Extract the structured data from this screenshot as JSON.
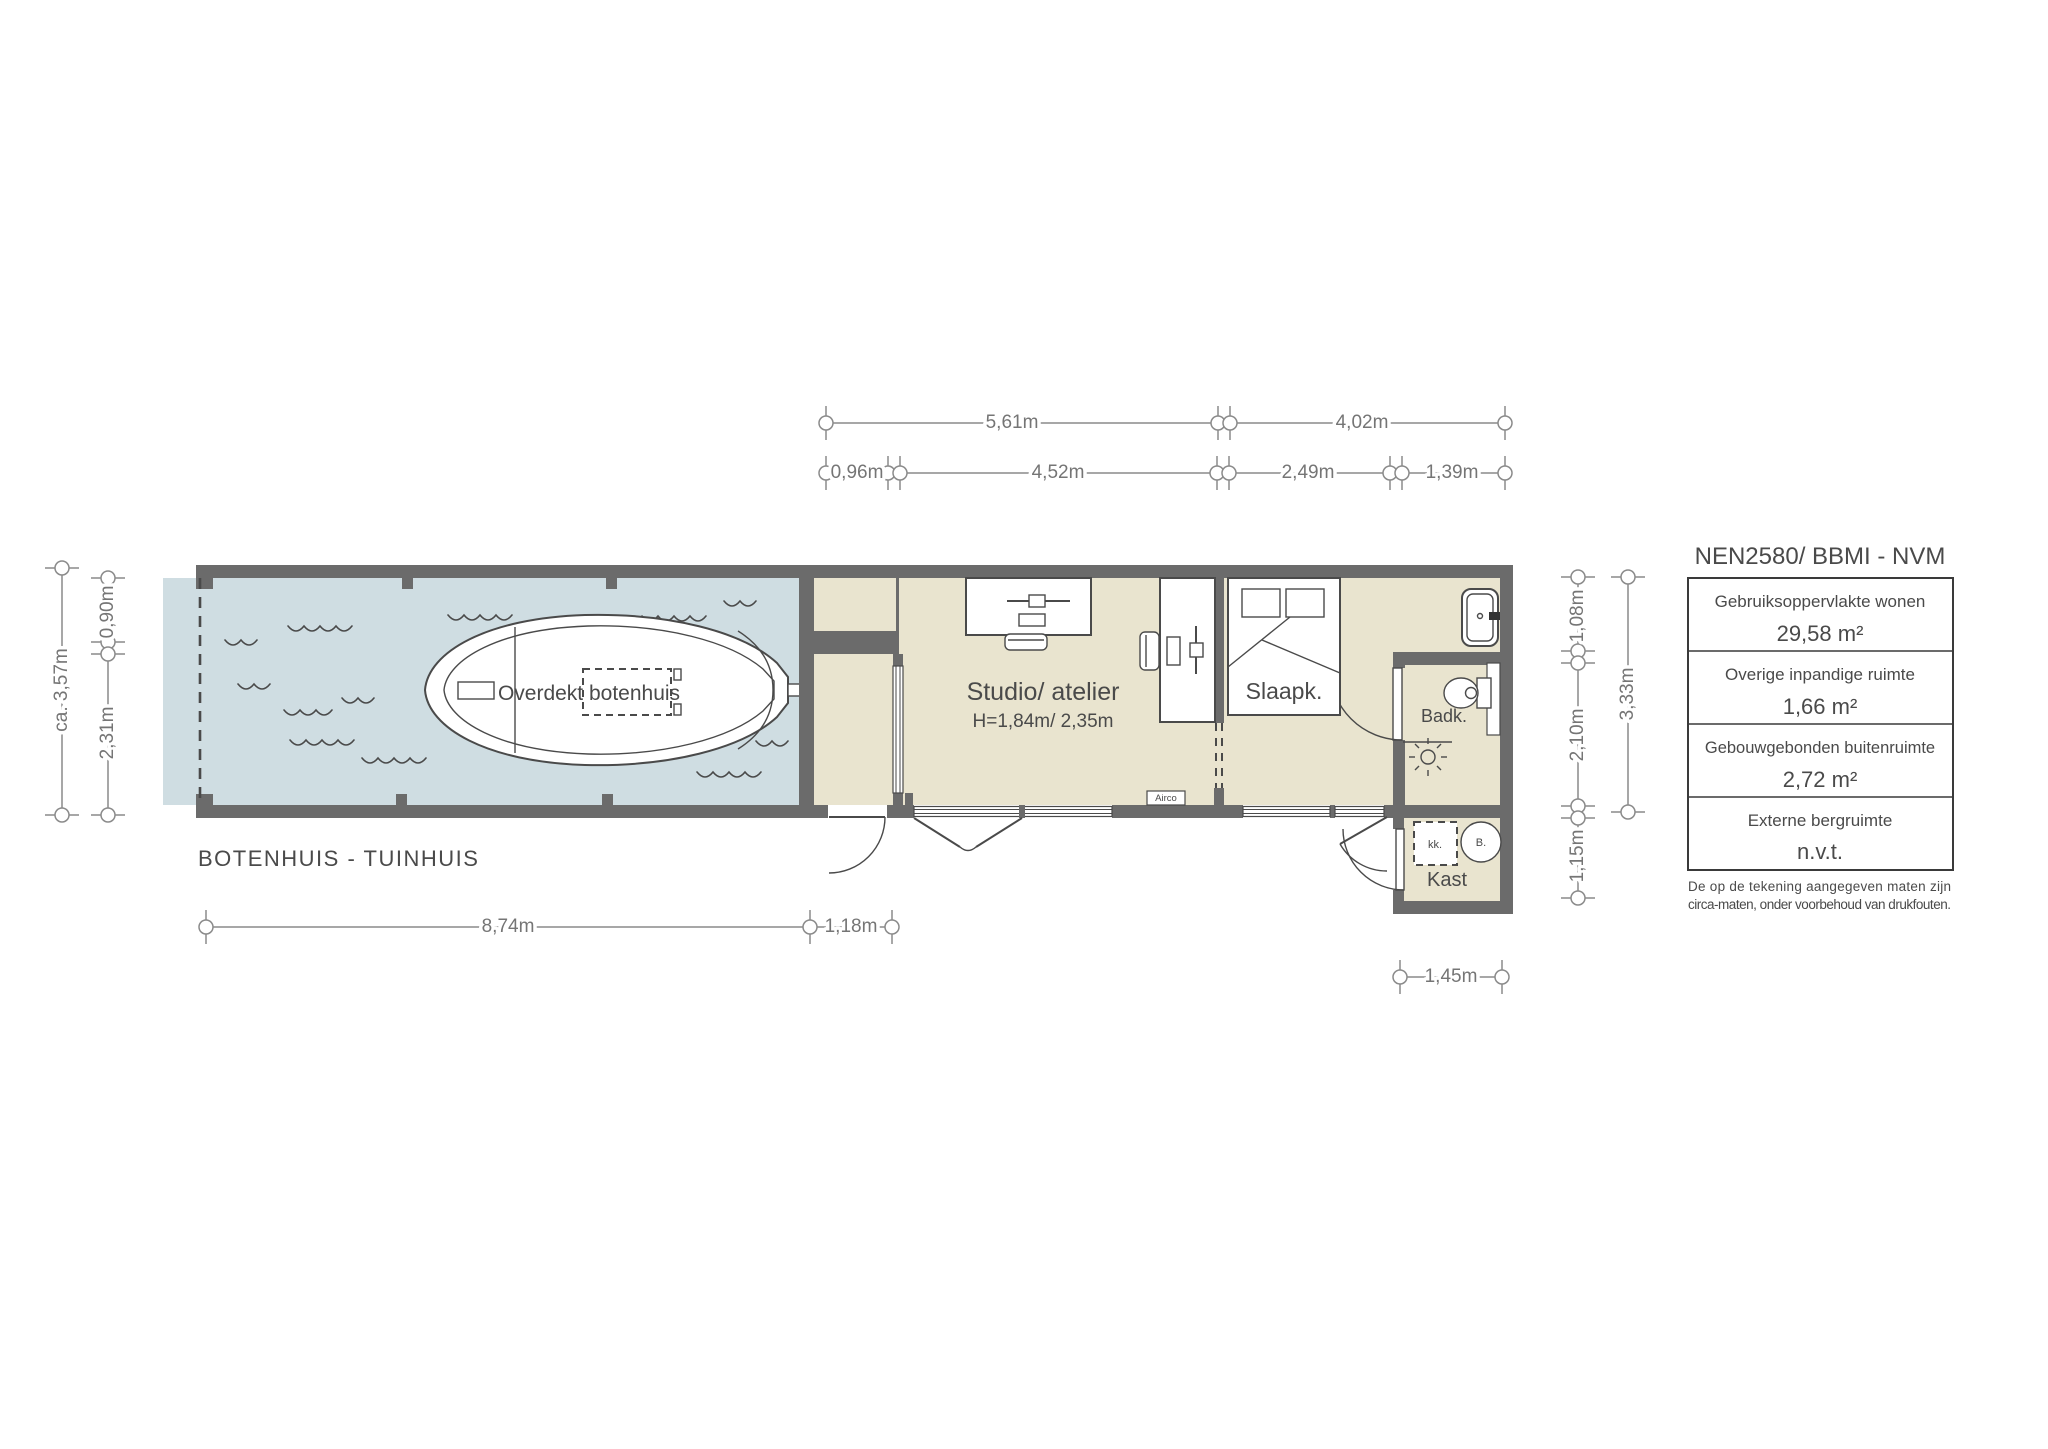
{
  "plan_title": "BOTENHUIS - TUINHUIS",
  "rooms": {
    "boathouse_boat": "Overdekt botenhuis",
    "studio": "Studio/ atelier",
    "studio_height": "H=1,84m/ 2,35m",
    "bedroom": "Slaapk.",
    "bathroom": "Badk.",
    "closet": "Kast",
    "fridge": "kk.",
    "boiler": "B.",
    "airco": "Airco"
  },
  "dimensions": {
    "top_outer": [
      "5,61m",
      "4,02m"
    ],
    "top_inner": [
      "0,96m",
      "4,52m",
      "2,49m",
      "1,39m"
    ],
    "left_outer": "ca. 3,57m",
    "left_inner": [
      "0,90m",
      "2,31m"
    ],
    "right_inner": [
      "1,08m",
      "2,10m",
      "1,15m"
    ],
    "right_outer": "3,33m",
    "bottom": [
      "8,74m",
      "1,18m"
    ],
    "closet_width": "1,45m"
  },
  "legend": {
    "title": "NEN2580/ BBMI - NVM",
    "rows": [
      {
        "label": "Gebruiksoppervlakte wonen",
        "value": "29,58 m²"
      },
      {
        "label": "Overige inpandige ruimte",
        "value": "1,66 m²"
      },
      {
        "label": "Gebouwgebonden buitenruimte",
        "value": "2,72 m²"
      },
      {
        "label": "Externe bergruimte",
        "value": "n.v.t."
      }
    ],
    "disclaimer": [
      "De op de tekening aangegeven maten zijn",
      "circa-maten, onder voorbehoud van drukfouten."
    ]
  },
  "colors": {
    "wall": "#6b6b6b",
    "water": "#cfdde2",
    "floor": "#e9e4cf",
    "dim_gray": "#8a8a8a",
    "text_gray": "#4a4a4a"
  }
}
